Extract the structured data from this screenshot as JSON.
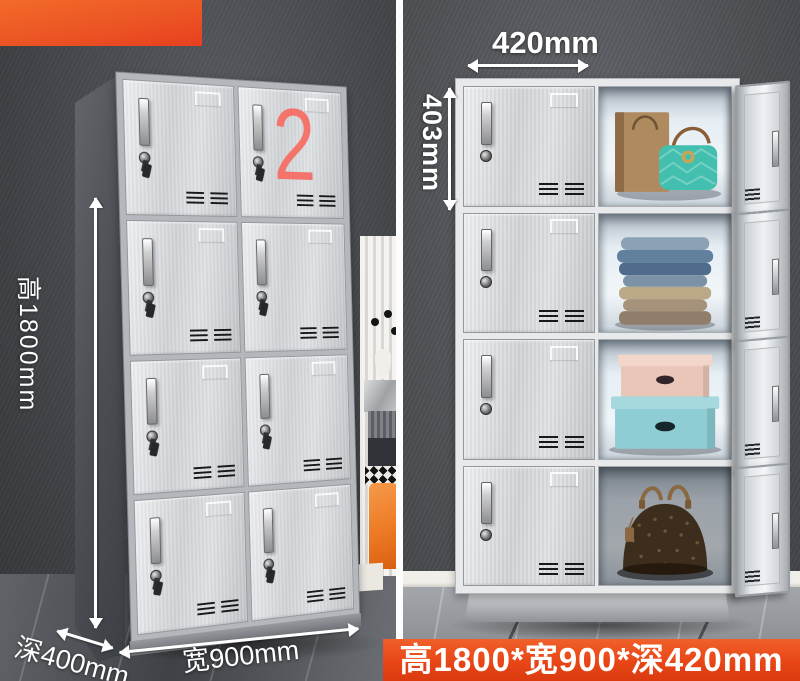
{
  "colors": {
    "badge_orange_top": "#f26a2a",
    "badge_orange_bottom": "#e8401f",
    "banner_red_top": "#f0602a",
    "banner_red_bottom": "#da3a0e",
    "number_pink": "#f4736b",
    "annotation_white": "#ffffff",
    "teal_bag": "#42bfae",
    "stool_orange": "#ed7a24"
  },
  "left_scene": {
    "locker_number": "2",
    "height_label": "高1800mm",
    "depth_label": "深400mm",
    "width_label": "宽900mm",
    "door_rows": 4,
    "door_cols": 2
  },
  "right_scene": {
    "width_label": "420mm",
    "height_label": "403mm",
    "items": {
      "row1": [
        "paper-shopping-bag",
        "teal-quilted-handbag"
      ],
      "row2": [
        "folded-denim-clothes",
        "folded-khaki-clothes"
      ],
      "row3": [
        "pink-storage-box",
        "blue-storage-box"
      ],
      "row4": [
        "brown-monogram-handbag"
      ]
    }
  },
  "banner": {
    "text": "高1800*宽900*深420mm"
  }
}
